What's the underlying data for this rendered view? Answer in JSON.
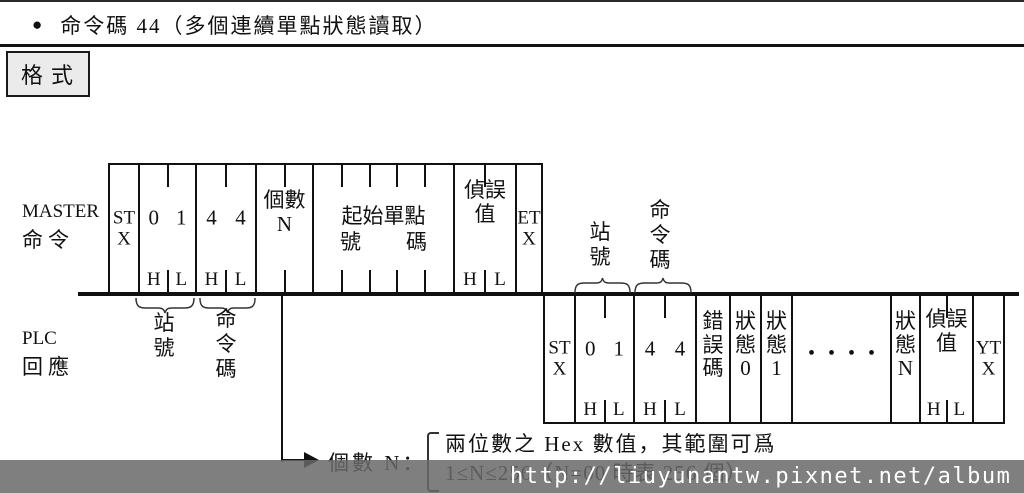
{
  "title": {
    "bullet": "●",
    "text": "命令碼 44（多個連續單點狀態讀取）"
  },
  "format_box": "格式",
  "labels": {
    "station": "站號",
    "command": "命令碼"
  },
  "master": {
    "label1": "MASTER",
    "label2": "命令",
    "stx": "STX",
    "station": {
      "d1": "0",
      "d2": "1",
      "h": "H",
      "l": "L"
    },
    "command": {
      "d1": "4",
      "d2": "4",
      "h": "H",
      "l": "L"
    },
    "count": "個數N",
    "start_line1": "起始單點",
    "start_no": "號",
    "start_ma": "碼",
    "checksum": {
      "text": "偵誤值",
      "h": "H",
      "l": "L"
    },
    "etx": "ETX"
  },
  "plc": {
    "label1": "PLC",
    "label2": "回應",
    "stx": "STX",
    "station": {
      "d1": "0",
      "d2": "1",
      "h": "H",
      "l": "L"
    },
    "command": {
      "d1": "4",
      "d2": "4",
      "h": "H",
      "l": "L"
    },
    "error": "錯誤碼",
    "status0": "狀態0",
    "status1": "狀態1",
    "dots": "••••",
    "statusN": "狀態N",
    "checksum": {
      "text": "偵誤值",
      "h": "H",
      "l": "L"
    },
    "etx": "YTX"
  },
  "note": {
    "pointer": "個數 N：",
    "line1": "兩位數之 Hex 數值，其範圍可爲",
    "line2": "1≤N≤256（N=00 時表 256 個）"
  },
  "watermark": "http://liuyunantw.pixnet.net/album"
}
